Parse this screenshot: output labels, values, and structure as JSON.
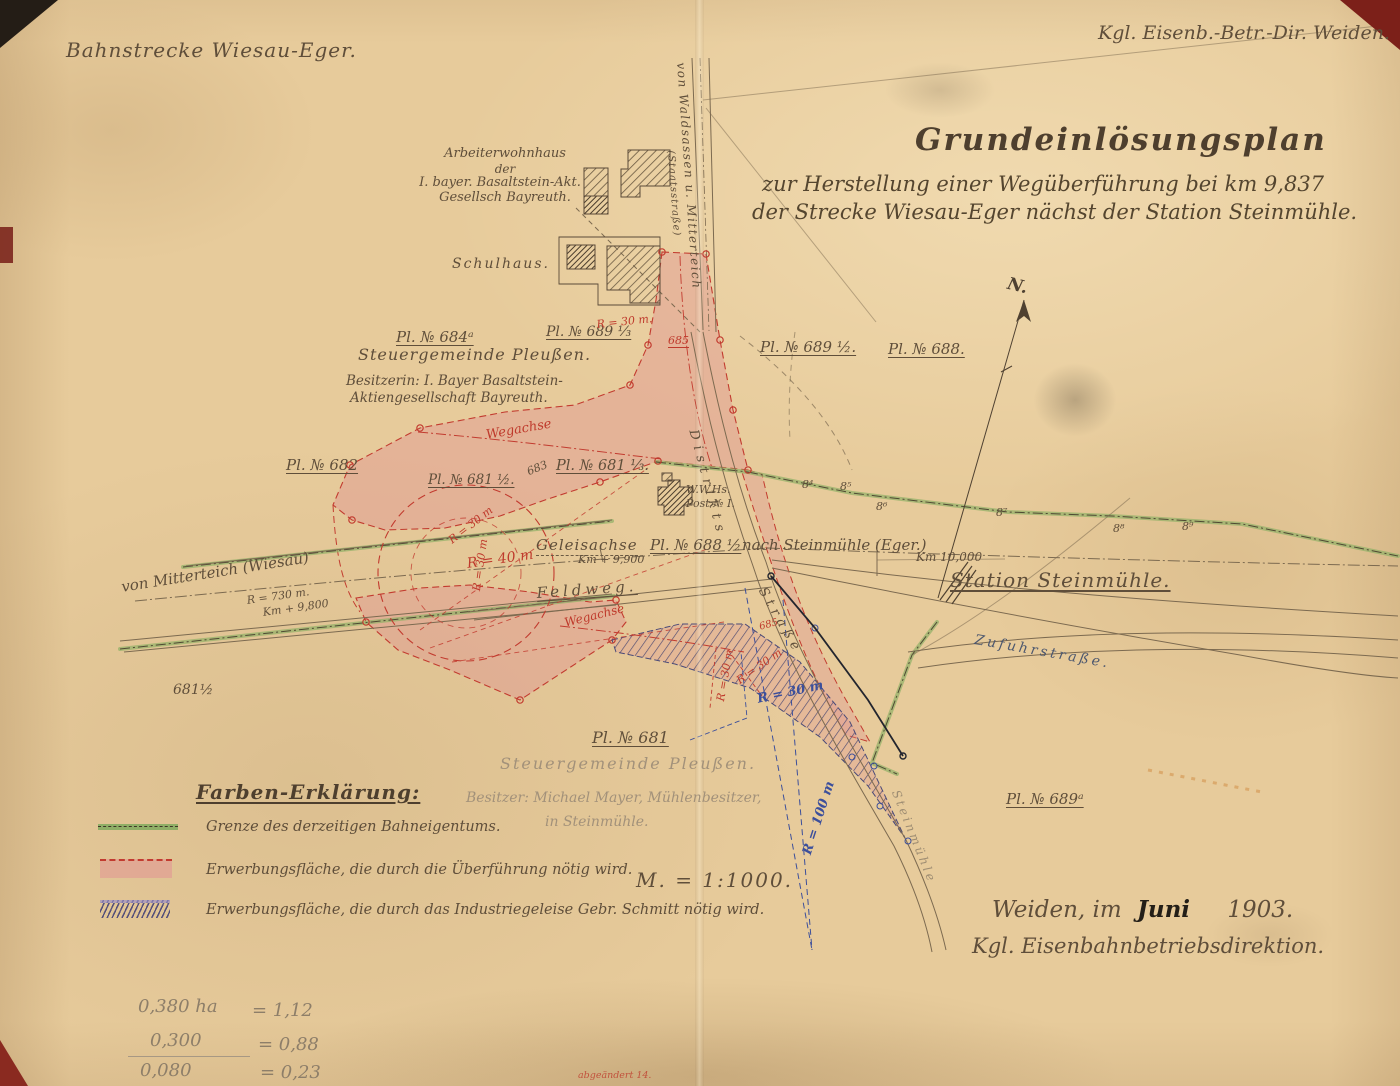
{
  "colors": {
    "paper": "#e7cb9b",
    "ink": "#5f4e3a",
    "red": "#bf3a2c",
    "pink": "#e79a9a",
    "green": "#8fae66",
    "blue": "#3c4f9b",
    "pencil": "#8d7e69"
  },
  "header": {
    "left": "Bahnstrecke Wiesau-Eger.",
    "right": "Kgl. Eisenb.-Betr.-Dir. Weiden."
  },
  "title": {
    "line1": "Grundeinlösungsplan",
    "line2": "zur Herstellung einer Wegüberführung bei km 9,837",
    "line3": "der Strecke Wiesau-Eger nächst der Station Steinmühle."
  },
  "map": {
    "buildings": {
      "arb1": "Arbeiterwohnhaus",
      "arb2": "der",
      "arb3": "I. bayer. Basaltstein-Akt.",
      "arb4": "Gesellsch Bayreuth.",
      "schulhaus": "Schulhaus.",
      "wwhs1": "W.W.Hs.",
      "wwhs2": "Post № I."
    },
    "roads": {
      "staatsstrasse1": "von Waldsassen u. Mitterteich",
      "staatsstrasse2": "(Staatsstraße)",
      "distrikts1": "Distrikts",
      "distrikts2": "Straße",
      "feldweg": "Feldweg.",
      "zufuhr": "Zufuhrstraße.",
      "muehlenweg": "Steinmühle",
      "wegachse1": "Wegachse",
      "wegachse2": "Wegachse",
      "geleisachse": "Geleisachse"
    },
    "parcels": {
      "pl684a": "Pl. № 684ᵃ",
      "pl689_13": "Pl. № 689 ⅓",
      "pl689_12": "Pl. № 689 ½.",
      "pl688": "Pl. № 688.",
      "pl682": "Pl. № 682",
      "pl681_12": "Pl. № 681 ½.",
      "pl681_13": "Pl. № 681 ⅓.",
      "pl688_12a": "Pl. № 688 ½",
      "pl688_12b": "nach Steinmühle (Eger.)",
      "pl681": "Pl. № 681",
      "pl689a": "Pl. № 689ᵃ",
      "n683": "683",
      "n685": "685",
      "n685b": "685",
      "n681_12": "681½"
    },
    "owners": {
      "gemeinde_top": "Steuergemeinde Pleußen.",
      "besitzerin1": "Besitzerin: I. Bayer Basaltstein-",
      "besitzerin2": "Aktiengesellschaft Bayreuth.",
      "gemeinde_bottom": "Steuergemeinde Pleußen.",
      "besitzer1": "Besitzer: Michael Mayer, Mühlenbesitzer,",
      "besitzer2": "in Steinmühle."
    },
    "station": {
      "name": "Station Steinmühle.",
      "km10000": "Km 10,000",
      "km9900": "Km + 9,900",
      "km9800": "Km + 9,800",
      "r730": "R = 730 m.",
      "von_mitterteich": "von Mitterteich (Wiesau)"
    },
    "radii": {
      "r30_top": "R = 30 m.",
      "r30_a": "R = 30 m",
      "r40": "R = 40 m",
      "r30_b": "R = 30 m",
      "r30_c": "R = 30 m",
      "r30_d": "R = 30 m",
      "r30_blue": "R = 30 m",
      "r100_blue": "R = 100 m"
    },
    "markers": {
      "m4": "8⁴",
      "m5": "8⁵",
      "m6": "8⁶",
      "m7": "8⁷",
      "m8": "8⁸",
      "m9": "8⁹"
    },
    "compass": "N."
  },
  "legend": {
    "title": "Farben-Erklärung:",
    "item1": "Grenze des derzeitigen Bahneigentums.",
    "item2": "Erwerbungsfläche, die durch die Überführung nötig wird.",
    "item3": "Erwerbungsfläche, die durch das Industriegeleise Gebr. Schmitt nötig wird."
  },
  "scale_note": "M. = 1:1000.",
  "signature": {
    "place": "Weiden, im",
    "month": "Juni",
    "year": "1903.",
    "authority": "Kgl. Eisenbahnbetriebsdirektion."
  },
  "calculations": {
    "rows": [
      {
        "area": "0,380 ha",
        "value": "= 1,12"
      },
      {
        "area": "0,300",
        "value": "= 0,88"
      },
      {
        "area": "0,080",
        "value": "= 0,23"
      }
    ]
  },
  "annotations": {
    "bottom_note": "abgeändert 14."
  }
}
